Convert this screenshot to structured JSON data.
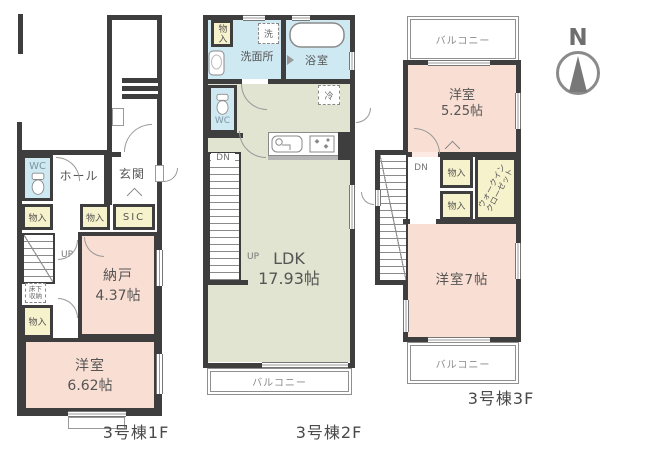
{
  "compass": {
    "north": "N"
  },
  "floor1": {
    "name": "3号棟1F",
    "wc": "WC",
    "hall": "ホール",
    "genkan": "玄関",
    "storage_a": "物入",
    "storage_b": "物入",
    "sic": "SIC",
    "up": "UP",
    "underfloor": "床下収納",
    "storage_c": "物入",
    "nando": "納戸",
    "nando_size": "4.37帖",
    "room": "洋室",
    "room_size": "6.62帖"
  },
  "floor2": {
    "name": "3号棟2F",
    "storage": "物入",
    "washroom": "洗面所",
    "washer": "洗",
    "bath": "浴室",
    "wc": "WC",
    "fridge": "冷",
    "dn": "DN",
    "up": "UP",
    "ldk": "LDK",
    "ldk_size": "17.93帖",
    "balcony": "バルコニー"
  },
  "floor3": {
    "name": "3号棟3F",
    "balcony_top": "バルコニー",
    "room_a": "洋室",
    "room_a_size": "5.25帖",
    "dn": "DN",
    "storage_a": "物入",
    "storage_b": "物入",
    "wic_line1": "ウォークイン",
    "wic_line2": "クローゼット",
    "room_b": "洋室7帖",
    "balcony_bottom": "バルコニー"
  }
}
